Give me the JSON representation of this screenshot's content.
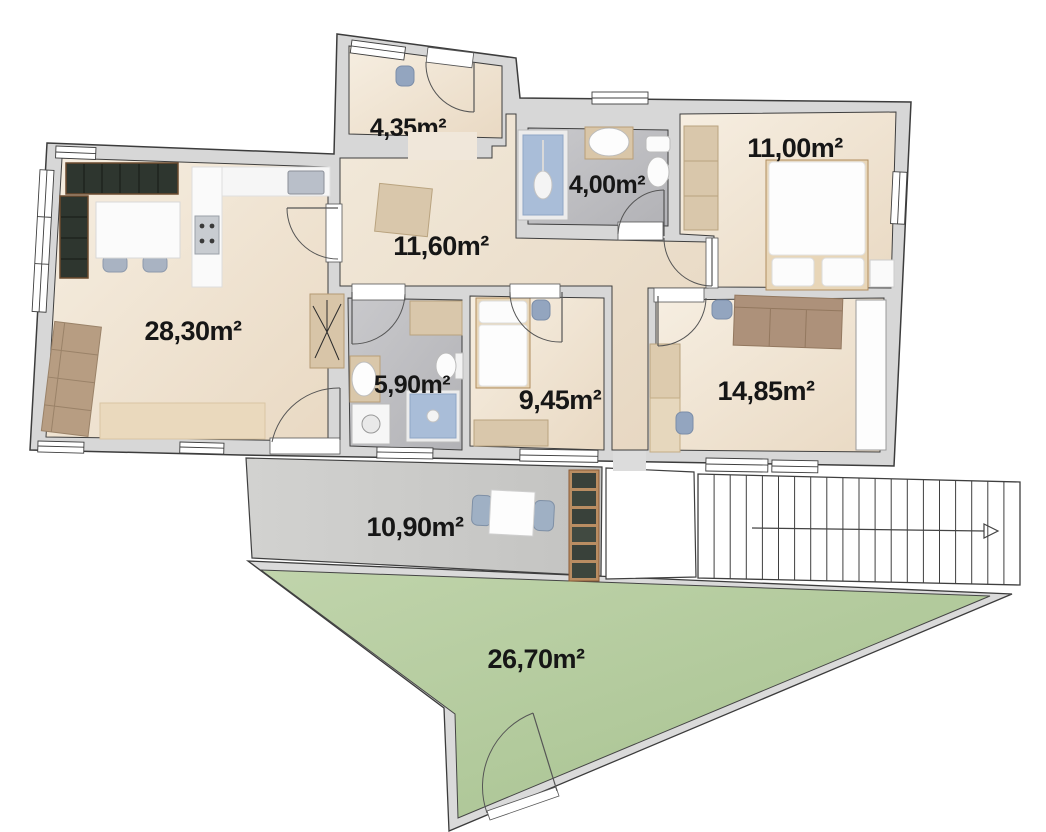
{
  "plan": {
    "title": "Apartment floor plan",
    "rooms": [
      {
        "name": "living-kitchen",
        "label": "28,30m²"
      },
      {
        "name": "hallway",
        "label": "11,60m²"
      },
      {
        "name": "storage-top",
        "label": "4,35m²"
      },
      {
        "name": "bathroom-top",
        "label": "4,00m²"
      },
      {
        "name": "bedroom-top-right",
        "label": "11,00m²"
      },
      {
        "name": "bathroom-small",
        "label": "5,90m²"
      },
      {
        "name": "bedroom-middle",
        "label": "9,45m²"
      },
      {
        "name": "bedroom-right",
        "label": "14,85m²"
      },
      {
        "name": "terrace",
        "label": "10,90m²"
      },
      {
        "name": "garden",
        "label": "26,70m²"
      }
    ],
    "staircase": {
      "steps": 20,
      "direction": "right"
    },
    "colors": {
      "wall": "#d7d7d7",
      "outline": "#3c3c3c",
      "floor_beige": "#f3eadc",
      "floor_marble": "#c2c2c5",
      "terrace_stone": "#cdcdcb",
      "garden_green": "#b7cda1",
      "kitchen_dark": "#2e362f",
      "furniture_wood": "#d9c7ab",
      "sofa_brown": "#ad917a",
      "seat_blue": "#8da0bb",
      "shower_blue": "#a9bdd8"
    }
  }
}
